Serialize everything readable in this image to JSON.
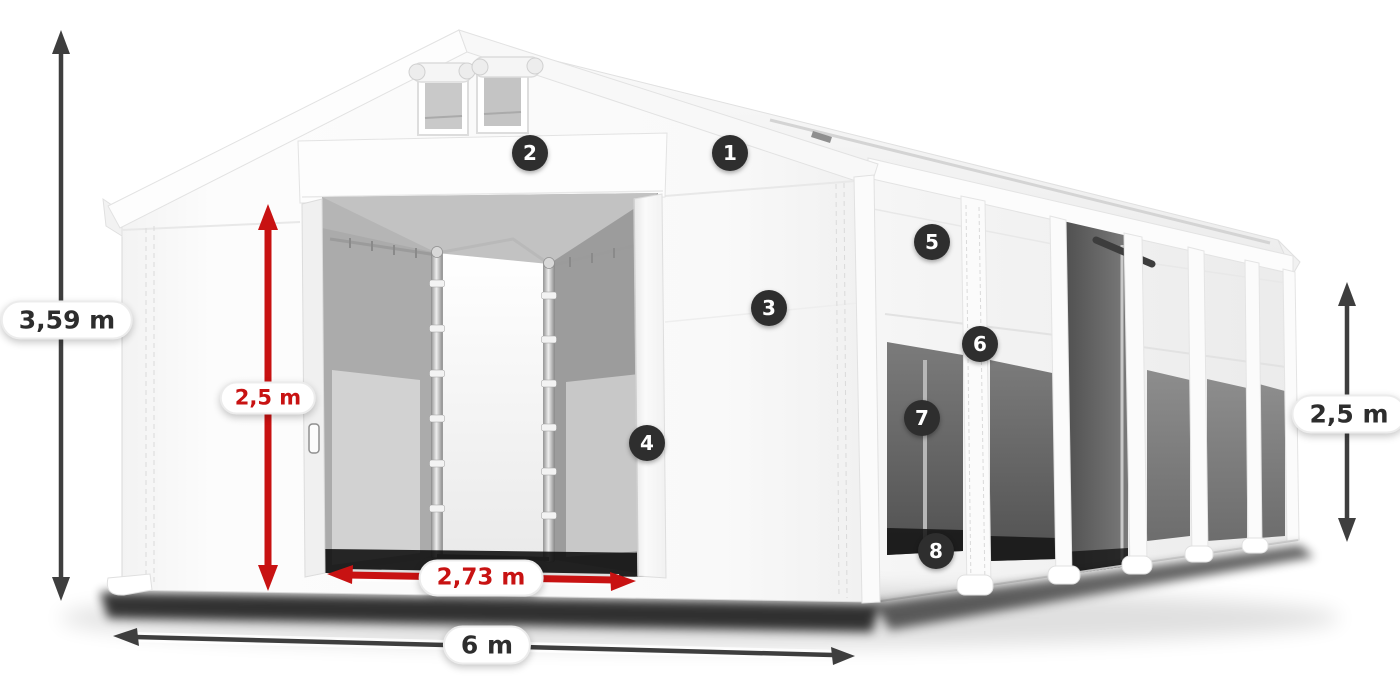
{
  "canvas": {
    "width": 1400,
    "height": 700,
    "background": "#ffffff"
  },
  "colors": {
    "accent_red": "#c81212",
    "dimension_dark": "#3e3e3e",
    "badge_background": "#2e2e2e",
    "badge_text": "#ffffff",
    "pill_background": "#ffffff",
    "pill_text_dark": "#2d2d2d"
  },
  "dimensions": [
    {
      "id": "total-height",
      "label": "3,59 m",
      "color": "dark",
      "orientation": "vertical",
      "position": "left"
    },
    {
      "id": "entrance-height",
      "label": "2,5 m",
      "color": "red",
      "orientation": "vertical",
      "position": "front-door"
    },
    {
      "id": "entrance-width",
      "label": "2,73 m",
      "color": "red",
      "orientation": "horizontal",
      "position": "front-door"
    },
    {
      "id": "total-width",
      "label": "6 m",
      "color": "dark",
      "orientation": "horizontal",
      "position": "bottom"
    },
    {
      "id": "side-height",
      "label": "2,5 m",
      "color": "dark",
      "orientation": "vertical",
      "position": "right"
    }
  ],
  "callouts": [
    {
      "number": "1"
    },
    {
      "number": "2"
    },
    {
      "number": "3"
    },
    {
      "number": "4"
    },
    {
      "number": "5"
    },
    {
      "number": "6"
    },
    {
      "number": "7"
    },
    {
      "number": "8"
    }
  ]
}
